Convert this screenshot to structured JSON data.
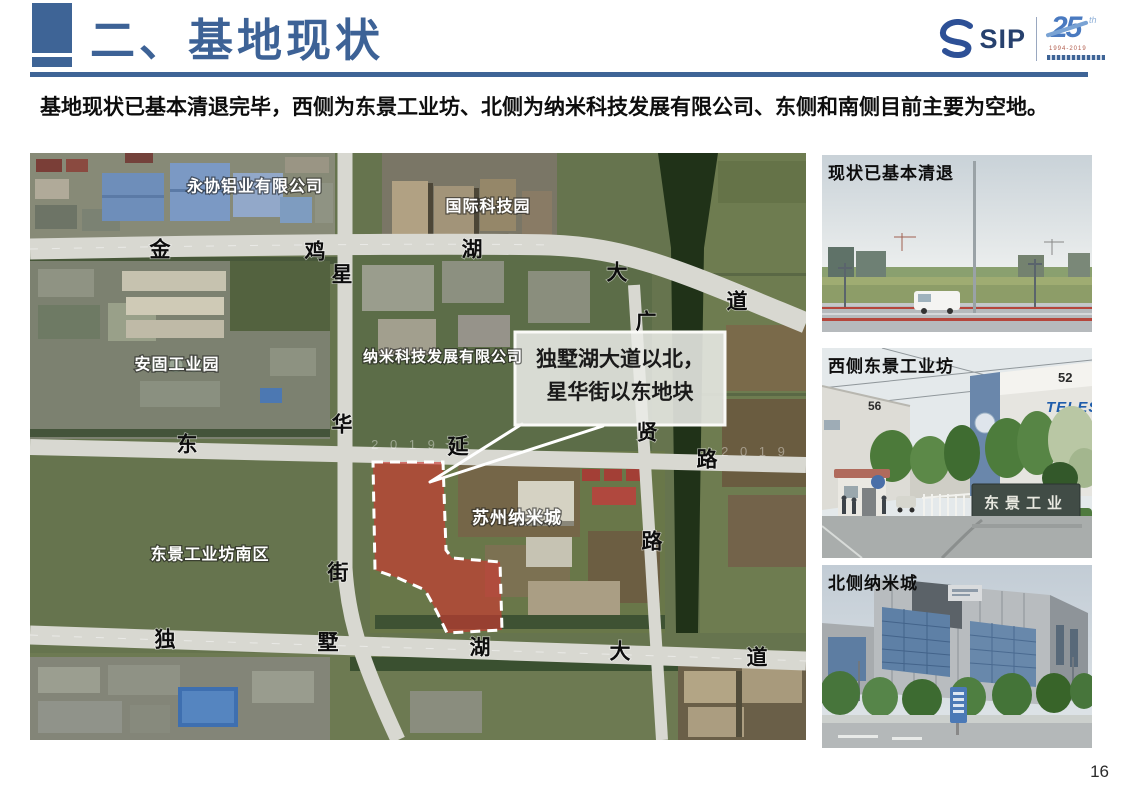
{
  "header": {
    "title": "二、基地现状",
    "logo": {
      "sip": "SIP",
      "anniversary": "25",
      "anniversary_sup": "th",
      "years": "1994-2019"
    }
  },
  "intro": "基地现状已基本清退完毕，西侧为东景工业坊、北侧为纳米科技发展有限公司、东侧和南侧目前主要为空地。",
  "colors": {
    "accent_blue": "#3e6496",
    "site_red": "#d03630"
  },
  "map": {
    "callout": {
      "line1": "独墅湖大道以北，",
      "line2": "星华街以东地块"
    },
    "area_labels": [
      {
        "text": "永协铝业有限公司",
        "x": 225,
        "y": 34,
        "size": 16
      },
      {
        "text": "国际科技园",
        "x": 458,
        "y": 54,
        "size": 16
      },
      {
        "text": "安固工业园",
        "x": 147,
        "y": 212,
        "size": 16
      },
      {
        "text": "纳米科技发展有限公司",
        "x": 413,
        "y": 204,
        "size": 15
      },
      {
        "text": "苏州纳米城",
        "x": 487,
        "y": 365,
        "size": 17
      },
      {
        "text": "东景工业坊南区",
        "x": 180,
        "y": 402,
        "size": 16
      }
    ],
    "road_chars": [
      {
        "text": "金",
        "x": 130,
        "y": 97
      },
      {
        "text": "鸡",
        "x": 285,
        "y": 99
      },
      {
        "text": "湖",
        "x": 442,
        "y": 97
      },
      {
        "text": "大",
        "x": 587,
        "y": 120
      },
      {
        "text": "道",
        "x": 707,
        "y": 149
      },
      {
        "text": "星",
        "x": 312,
        "y": 122
      },
      {
        "text": "华",
        "x": 312,
        "y": 272
      },
      {
        "text": "街",
        "x": 308,
        "y": 420
      },
      {
        "text": "东",
        "x": 157,
        "y": 292
      },
      {
        "text": "延",
        "x": 428,
        "y": 294
      },
      {
        "text": "路",
        "x": 677,
        "y": 307
      },
      {
        "text": "广",
        "x": 616,
        "y": 169
      },
      {
        "text": "贤",
        "x": 617,
        "y": 280
      },
      {
        "text": "路",
        "x": 622,
        "y": 389
      },
      {
        "text": "独",
        "x": 135,
        "y": 487
      },
      {
        "text": "墅",
        "x": 298,
        "y": 490
      },
      {
        "text": "湖",
        "x": 450,
        "y": 495
      },
      {
        "text": "大",
        "x": 590,
        "y": 499
      },
      {
        "text": "道",
        "x": 727,
        "y": 505
      }
    ],
    "watermarks": [
      {
        "text": "2 0 1 9",
        "x": 375,
        "y": 296
      },
      {
        "text": "2 0 1 9",
        "x": 725,
        "y": 303
      }
    ]
  },
  "photos": [
    {
      "caption": "现状已基本清退"
    },
    {
      "caption": "西侧东景工业坊",
      "labels": {
        "building_left": "56",
        "building_right": "52",
        "brand": "TELES",
        "gate_sign": "东景工业"
      }
    },
    {
      "caption": "北侧纳米城"
    }
  ],
  "page_number": "16"
}
